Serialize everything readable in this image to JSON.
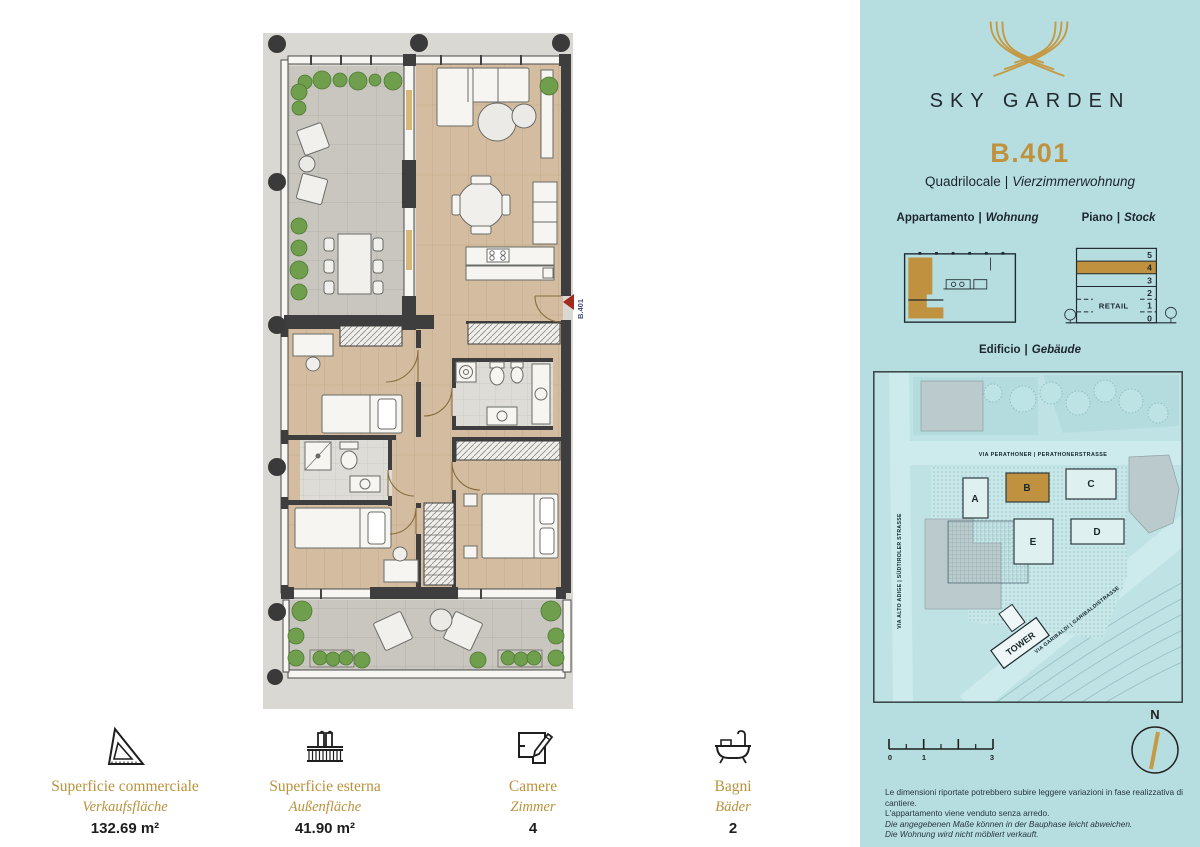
{
  "header": {
    "project": "SKY GARDEN",
    "unit": "B.401",
    "type_it": "Quadrilocale",
    "type_de": "Vierzimmerwohnung",
    "separator": "|"
  },
  "sections": {
    "apartment_label_it": "Appartamento",
    "apartment_label_de": "Wohnung",
    "floor_label_it": "Piano",
    "floor_label_de": "Stock",
    "building_label_it": "Edificio",
    "building_label_de": "Gebäude",
    "separator": "|"
  },
  "floor_diagram": {
    "floors": [
      "5",
      "4",
      "3",
      "2",
      "1",
      "0"
    ],
    "highlighted_floor": "4",
    "retail_label": "RETAIL"
  },
  "site_map": {
    "buildings": [
      "A",
      "B",
      "C",
      "D",
      "E"
    ],
    "highlighted_building": "B",
    "streets": {
      "north": "VIA PERATHONER | PERATHONERSTRASSE",
      "west": "VIA ALTO ADIGE | SÜDTIROLER STRASSE",
      "south": "VIA GARIBALDI | GARIBALDISTRASSE"
    },
    "tower_label": "TOWER"
  },
  "scale_bar": {
    "labels": [
      "0",
      "1",
      "3"
    ]
  },
  "compass": {
    "label": "N"
  },
  "disclaimer": {
    "line1": "Le dimensioni riportate potrebbero subire leggere variazioni in fase realizzativa di cantiere.",
    "line2": "L'appartamento viene venduto senza arredo.",
    "line3": "Die angegebenen Maße können in der Bauphase leicht abweichen.",
    "line4": "Die Wohnung wird nicht möbliert verkauft."
  },
  "metrics": {
    "items": [
      {
        "icon": "set-square-icon",
        "label_it": "Superficie commerciale",
        "label_de": "Verkaufsfläche",
        "value": "132.69 m²"
      },
      {
        "icon": "balcony-icon",
        "label_it": "Superficie esterna",
        "label_de": "Außenfläche",
        "value": "41.90 m²"
      },
      {
        "icon": "room-plan-icon",
        "label_it": "Camere",
        "label_de": "Zimmer",
        "value": "4"
      },
      {
        "icon": "bathtub-icon",
        "label_it": "Bagni",
        "label_de": "Bäder",
        "value": "2"
      }
    ]
  },
  "floor_plan": {
    "entrance_label": "B.401"
  },
  "colors": {
    "sidebar_teal": "#b6dee1",
    "accent_gold": "#c0923f",
    "entrance_red": "#a32a1f",
    "dark_text": "#1f2c33",
    "wood_floor": "#d3bc9f",
    "terrace_tile": "#c9c6bf",
    "wall_dark": "#3e3e3e"
  }
}
